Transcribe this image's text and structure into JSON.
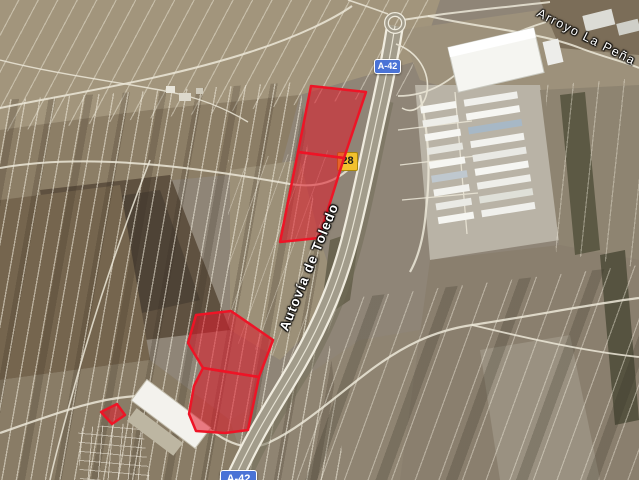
{
  "map": {
    "view_type": "satellite",
    "badges": {
      "a42_top": {
        "label": "A-42"
      },
      "a42_bottom": {
        "label": "A-42"
      },
      "km28": {
        "label": "28"
      }
    },
    "road_labels": {
      "autovia": {
        "label": "Autovía de Toledo"
      }
    },
    "place_labels": {
      "arroyo": {
        "label": "Arroyo La Peña"
      }
    },
    "colors": {
      "parcel_fill": "#e01828",
      "parcel_stroke": "#ee1426",
      "badge_blue": "#4a73d6",
      "badge_yellow": "#f2c12e",
      "badge_yellow_border": "#a8860b"
    },
    "overlays": {
      "fill_opacity": 0.55,
      "stroke_width": 2.5,
      "parcels": [
        {
          "id": "north-upper",
          "points": "311,86 366,92 344,158 298,152"
        },
        {
          "id": "north-lower",
          "points": "298,152 344,158 319,238 280,242"
        },
        {
          "id": "south-upper",
          "points": "196,315 231,311 273,340 259,377 203,368 188,343"
        },
        {
          "id": "south-lower",
          "points": "203,368 259,377 248,430 225,433 196,431 189,414 194,386"
        },
        {
          "id": "west-small",
          "points": "101,412 117,404 125,415 112,424"
        }
      ]
    }
  }
}
